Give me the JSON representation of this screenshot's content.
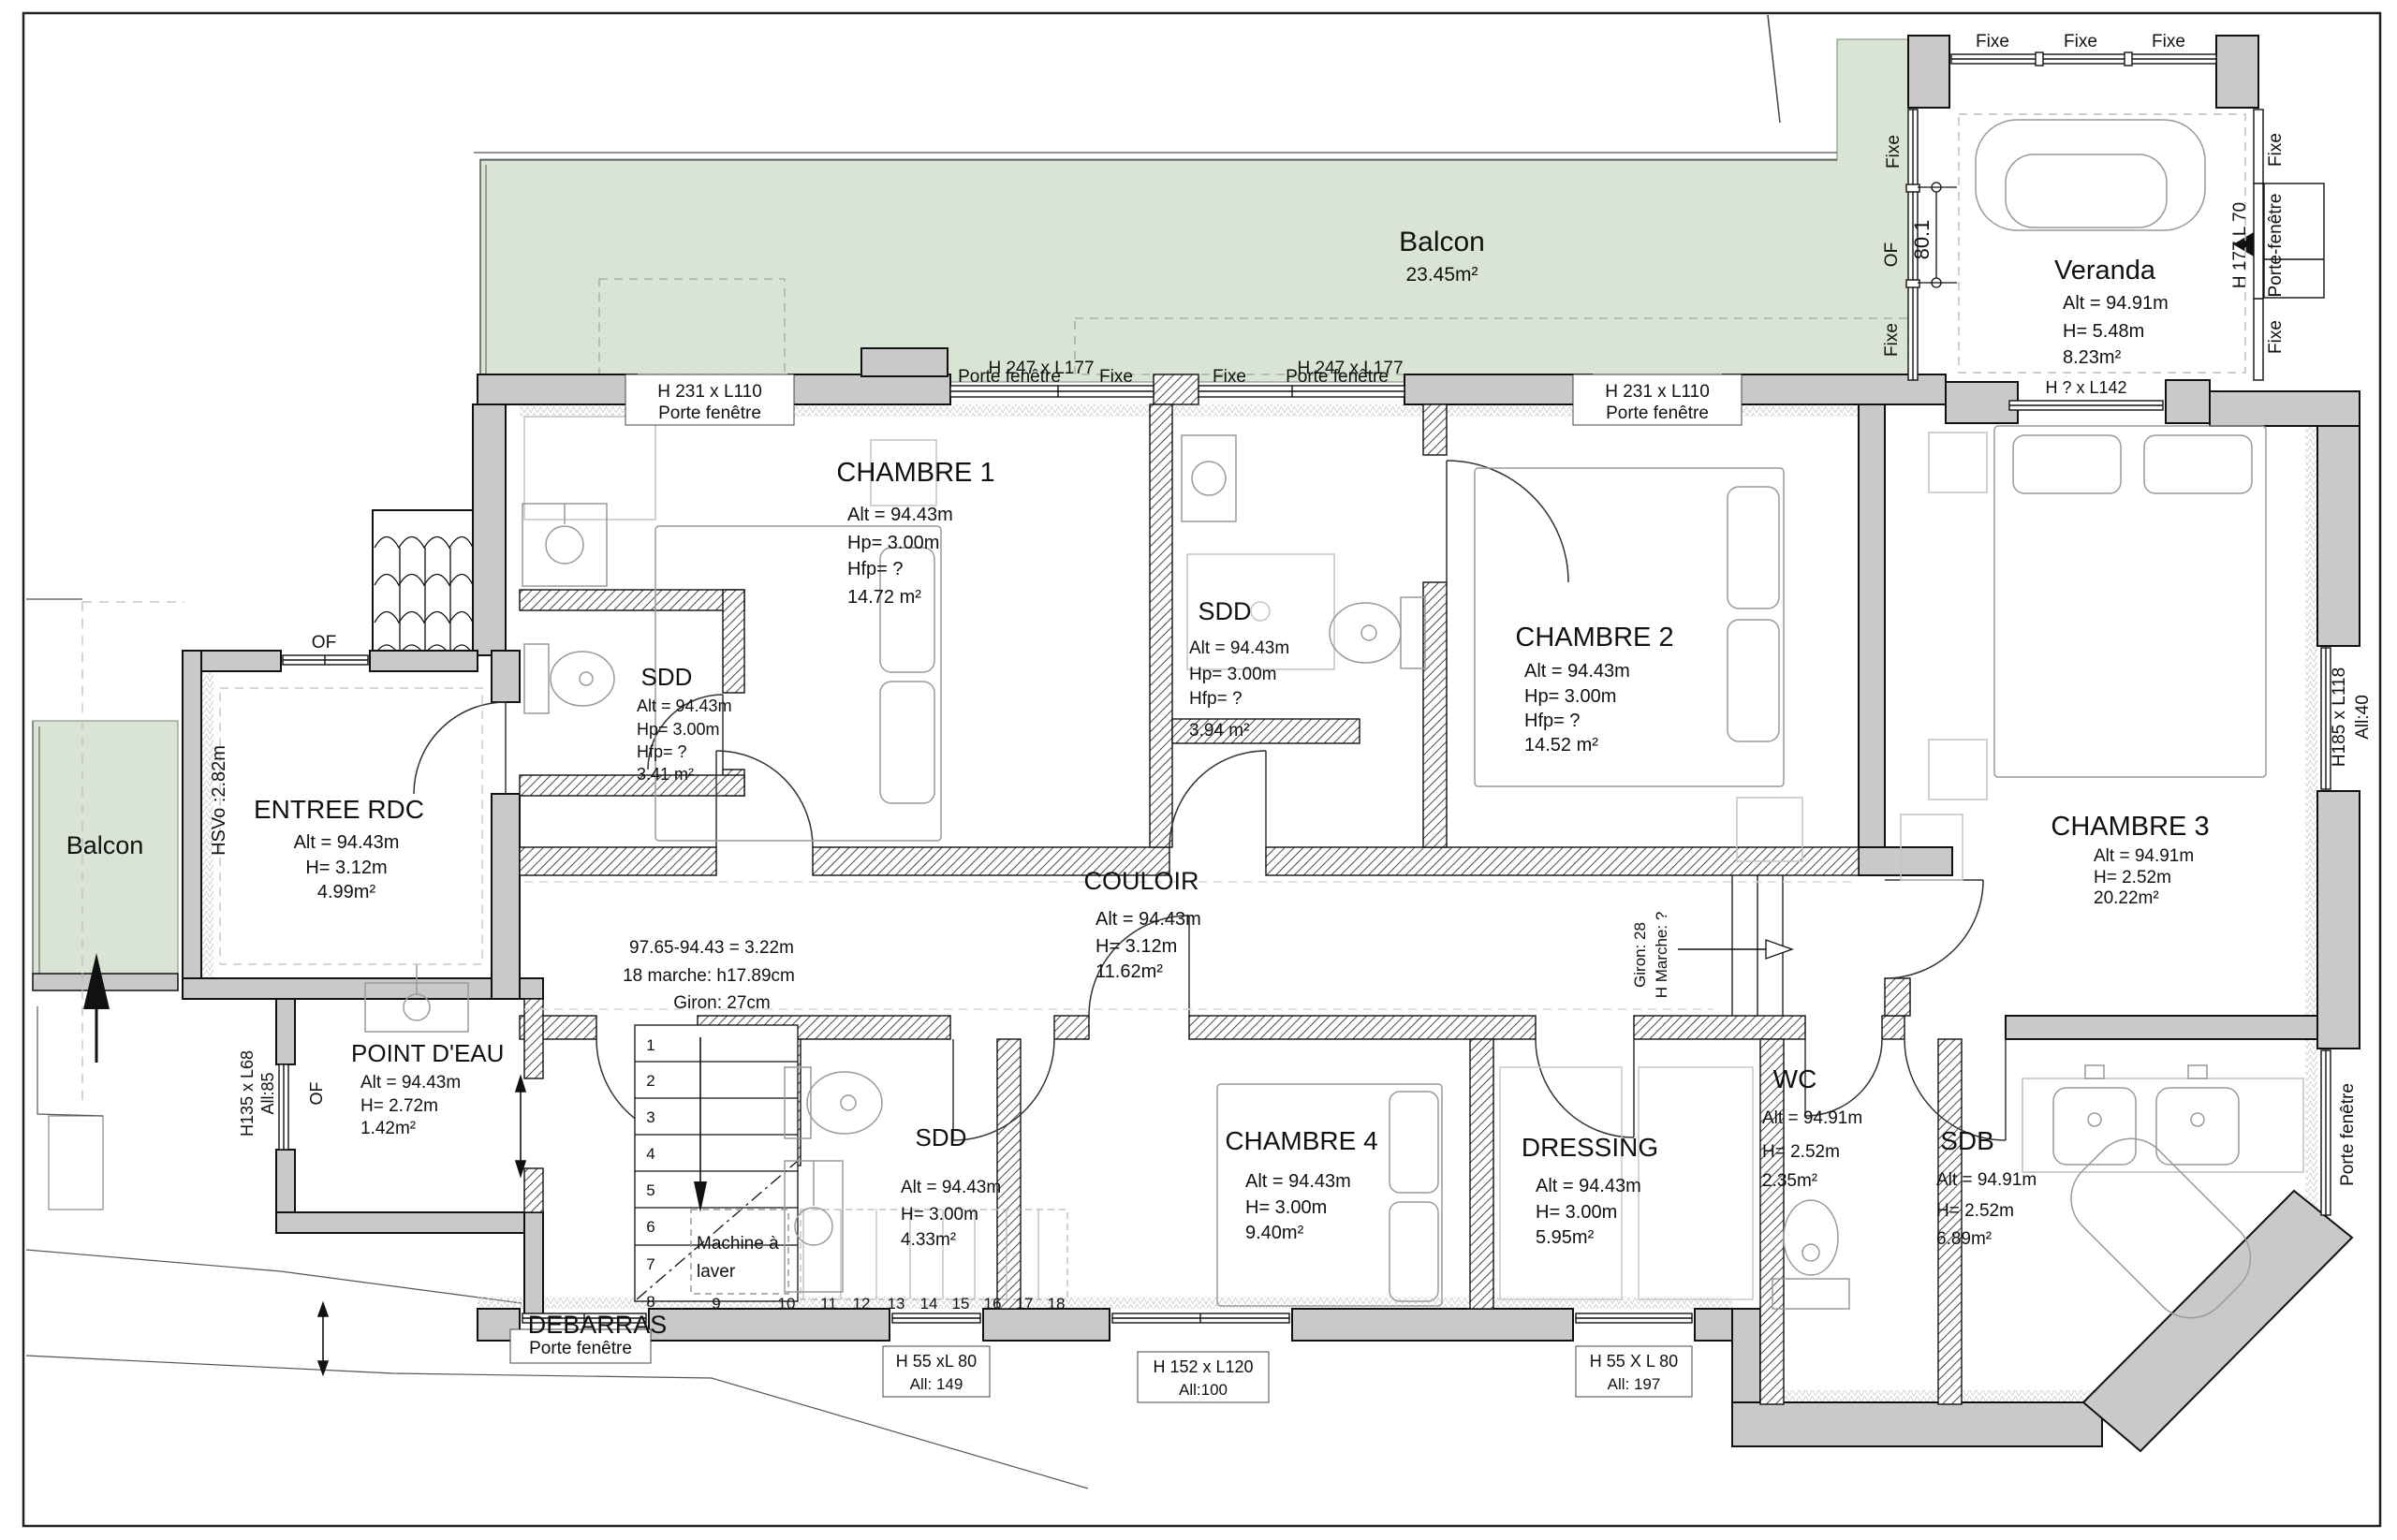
{
  "rooms": {
    "balcon_top": {
      "title": "Balcon",
      "area": "23.45m²"
    },
    "balcon_left": {
      "title": "Balcon"
    },
    "veranda": {
      "title": "Veranda",
      "alt": "Alt = 94.91m",
      "h": "H= 5.48m",
      "area": "8.23m²"
    },
    "chambre1": {
      "title": "CHAMBRE 1",
      "alt": "Alt = 94.43m",
      "hp": "Hp= 3.00m",
      "hfp": "Hfp= ?",
      "area": "14.72 m²"
    },
    "sdd_top": {
      "title": "SDD",
      "alt": "Alt = 94.43m",
      "hp": "Hp= 3.00m",
      "hfp": "Hfp= ?",
      "area": "3.94 m²"
    },
    "chambre2": {
      "title": "CHAMBRE 2",
      "alt": "Alt = 94.43m",
      "hp": "Hp= 3.00m",
      "hfp": "Hfp= ?",
      "area": "14.52 m²"
    },
    "sdd_left": {
      "title": "SDD",
      "alt": "Alt = 94.43m",
      "hp": "Hp= 3.00m",
      "hfp": "Hfp= ?",
      "area": "3.41 m²"
    },
    "entree": {
      "title": "ENTREE RDC",
      "alt": "Alt = 94.43m",
      "h": "H= 3.12m",
      "area": "4.99m²"
    },
    "couloir": {
      "title": "COULOIR",
      "alt": "Alt = 94.43m",
      "h": "H= 3.12m",
      "area": "11.62m²"
    },
    "point_eau": {
      "title": "POINT D'EAU",
      "alt": "Alt = 94.43m",
      "h": "H= 2.72m",
      "area": "1.42m²"
    },
    "sdd_bottom": {
      "title": "SDD",
      "alt": "Alt = 94.43m",
      "h": "H= 3.00m",
      "area": "4.33m²"
    },
    "debarras": {
      "title": "DEBARRAS"
    },
    "chambre4": {
      "title": "CHAMBRE 4",
      "alt": "Alt = 94.43m",
      "h": "H= 3.00m",
      "area": "9.40m²"
    },
    "dressing": {
      "title": "DRESSING",
      "alt": "Alt = 94.43m",
      "h": "H= 3.00m",
      "area": "5.95m²"
    },
    "wc": {
      "title": "WC",
      "alt": "Alt = 94.91m",
      "h": "H= 2.52m",
      "area": "2.35m²"
    },
    "sdb": {
      "title": "SDB",
      "alt": "Alt = 94.91m",
      "h": "H= 2.52m",
      "area": "6.89m²"
    },
    "chambre3": {
      "title": "CHAMBRE 3",
      "alt": "Alt = 94.91m",
      "h": "H= 2.52m",
      "area": "20.22m²"
    }
  },
  "windows": {
    "balcony_dim1": "H 247 x L177",
    "balcony_dim2": "H 247 x L177",
    "top_left_dim": "H 231 x L110",
    "top_left_type": "Porte fenêtre",
    "top_pf1": "Porte fenêtre",
    "top_fixe1": "Fixe",
    "top_fixe2": "Fixe",
    "top_pf2": "Porte fenêtre",
    "top_right_dim": "H 231 x L110",
    "top_right_type": "Porte fenêtre",
    "veranda_fixe_top1": "Fixe",
    "veranda_fixe_top2": "Fixe",
    "veranda_fixe_top3": "Fixe",
    "veranda_left_fixe1": "Fixe",
    "veranda_left_of": "OF",
    "veranda_left_fixe2": "Fixe",
    "veranda_left_dim": "80.1",
    "veranda_right_fixe1": "Fixe",
    "veranda_right_dim": "H 177 L 70",
    "veranda_right_pf": "Porte-fenêtre",
    "veranda_right_fixe2": "Fixe",
    "veranda_bottom_dim": "H ? x L142",
    "east_dim": "H185 x L118",
    "east_all": "All:40",
    "east_pf": "Porte fenêtre",
    "entree_of": "OF",
    "entree_hsvo": "HSVo :2.82m",
    "pde_dim": "H135 x L68",
    "pde_all": "All:85",
    "pde_of": "OF",
    "south_pf": "Porte fenêtre",
    "south_w1_dim": "H 55 xL 80",
    "south_w1_all": "All: 149",
    "south_w2_dim": "H 152 x L120",
    "south_w2_all": "All:100",
    "south_w3_dim": "H 55 X L 80",
    "south_w3_all": "All: 197"
  },
  "stairs": {
    "note1": "97.65-94.43 = 3.22m",
    "note2": "18 marche: h17.89cm",
    "note3": "Giron: 27cm",
    "machine_line1": "Machine à",
    "machine_line2": "laver",
    "marche_note1": "Giron: 28",
    "marche_note2": "H Marche: ?",
    "steps_v": [
      "1",
      "2",
      "3",
      "4",
      "5",
      "6",
      "7",
      "8"
    ],
    "steps_h": [
      "9",
      "10",
      "11",
      "12",
      "13",
      "14",
      "15",
      "16",
      "17",
      "18"
    ]
  },
  "colors": {
    "balcony_green": "#d9e4d4",
    "wall_gray": "#c9c9c9"
  }
}
